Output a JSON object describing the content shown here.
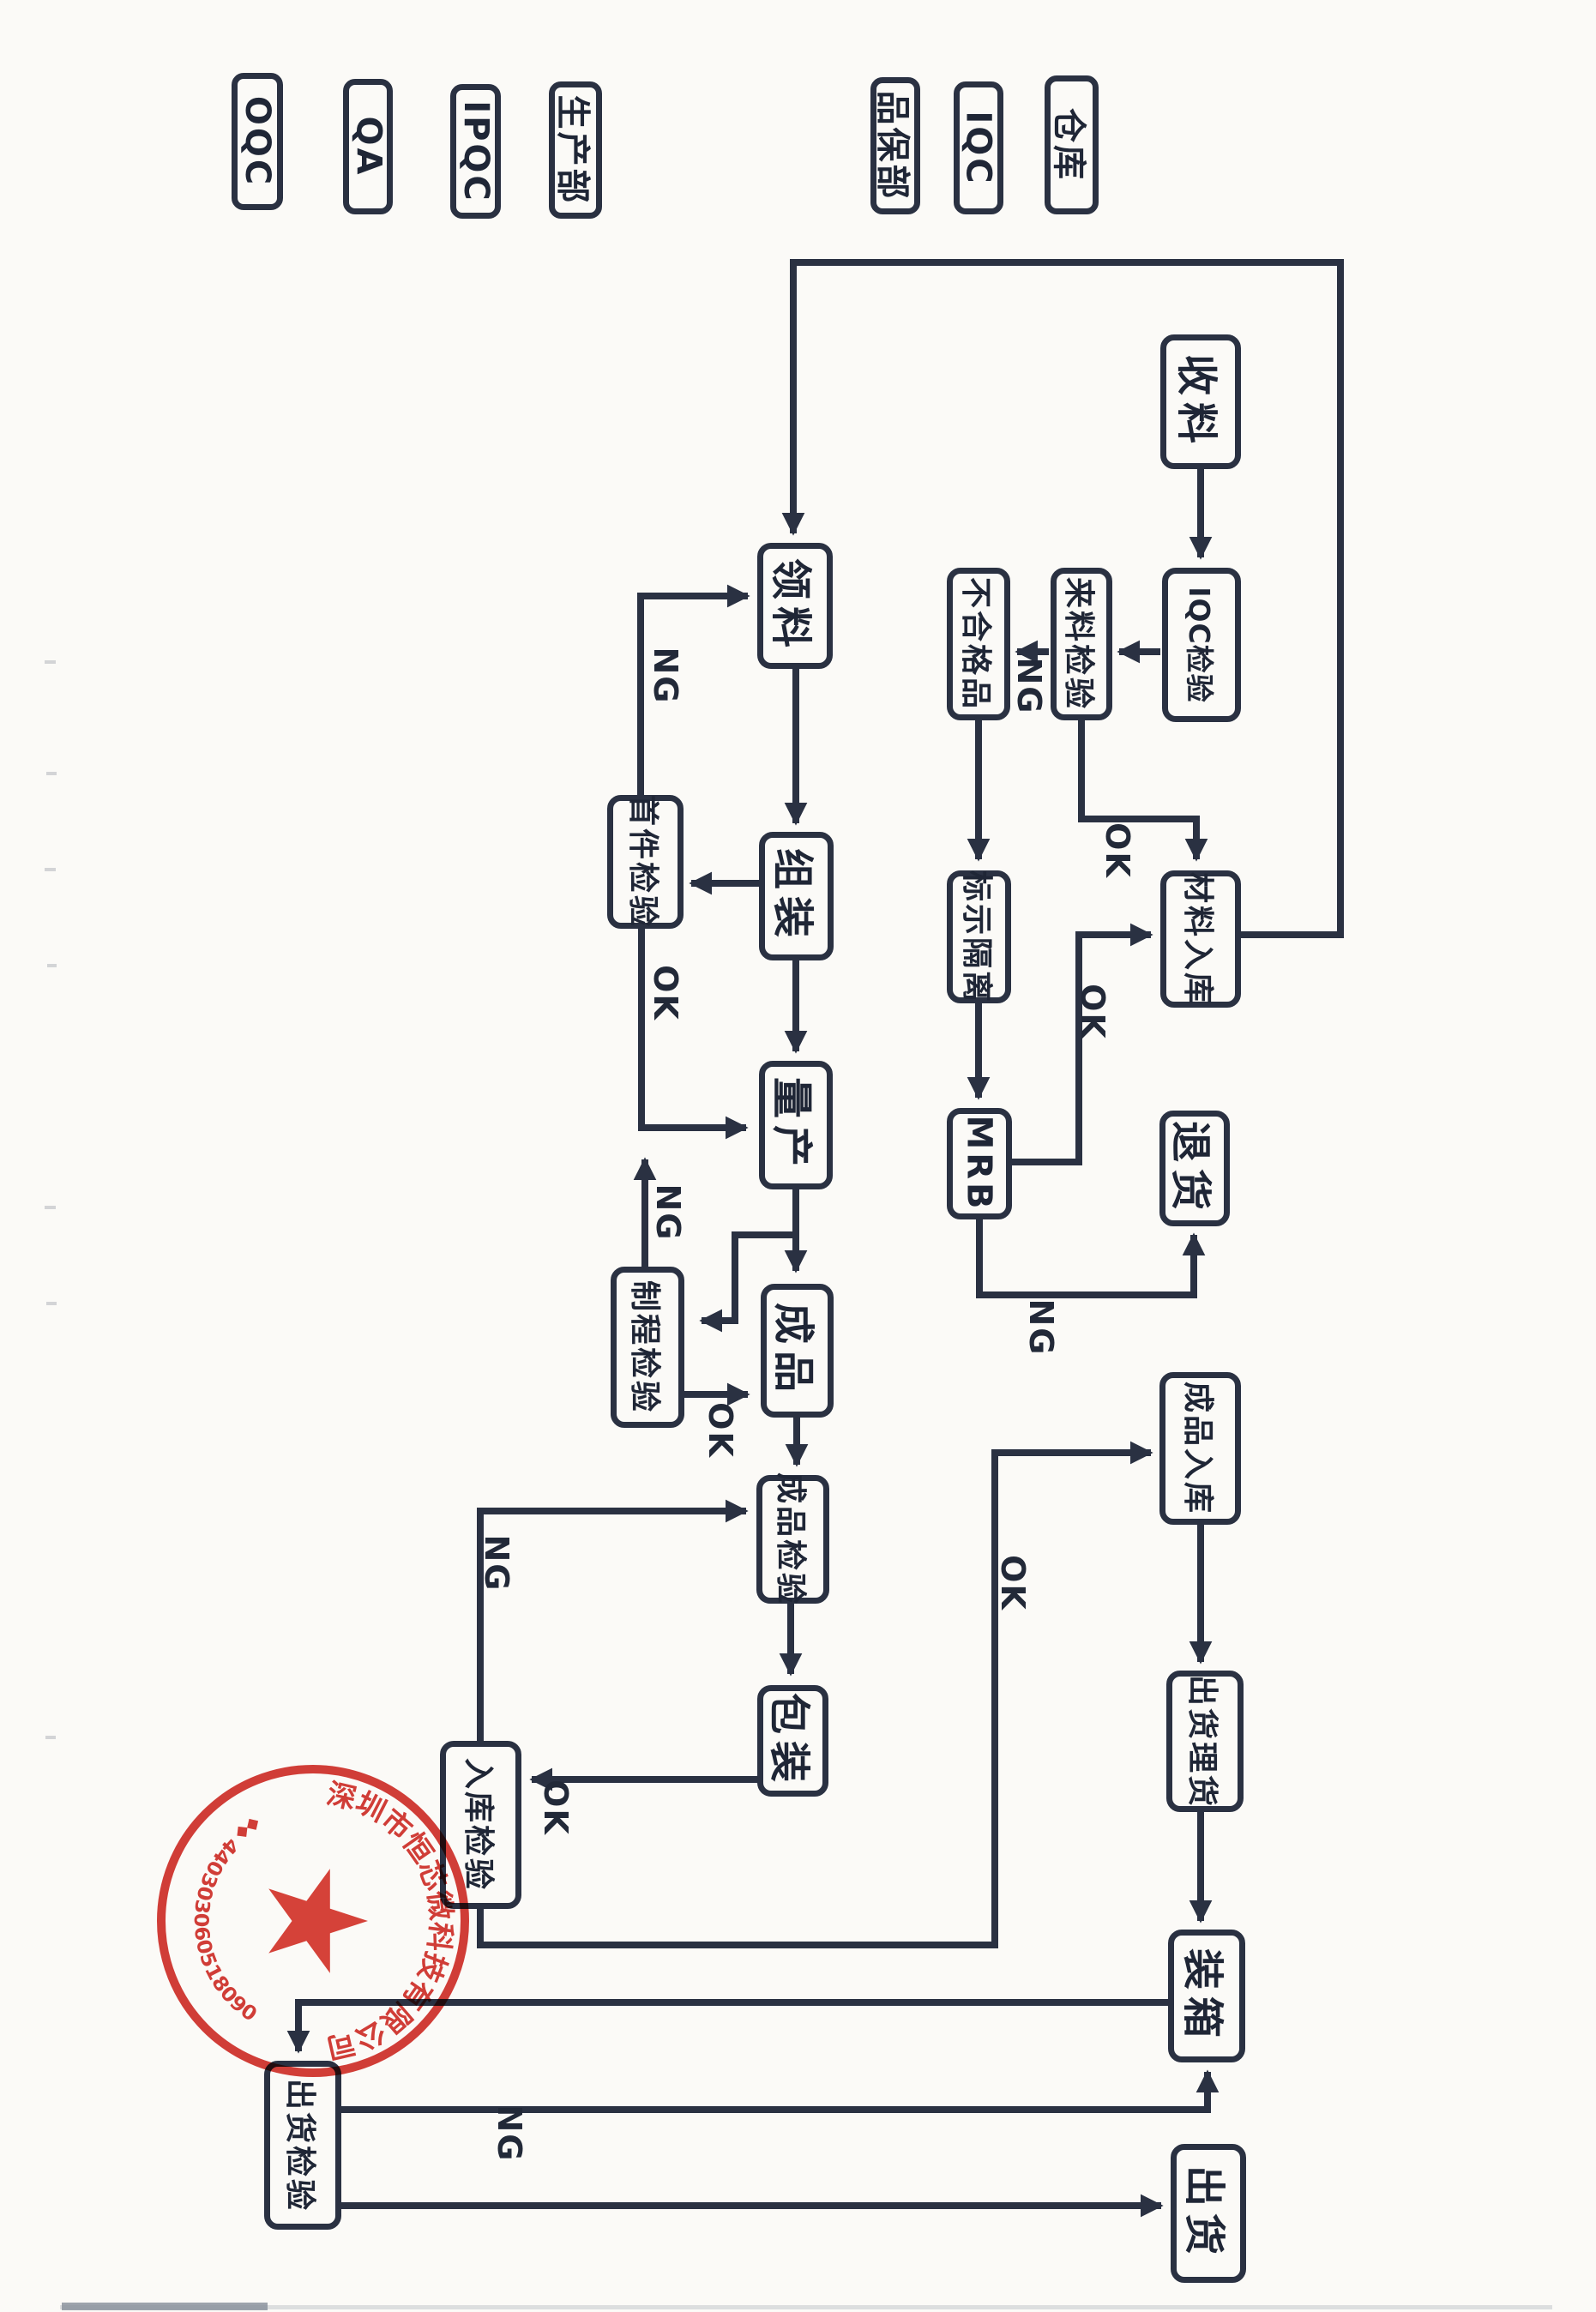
{
  "colors": {
    "ink": "#2a3142",
    "paper": "#fbfaf7",
    "stamp_red": "#cf241e"
  },
  "lanes": [
    "OQC",
    "QA",
    "IPQC",
    "生产部",
    "品保部",
    "IQC",
    "仓库"
  ],
  "nodes": {
    "receive_material": {
      "label": "收料"
    },
    "iqc_inspection": {
      "label": "IQC检验"
    },
    "incoming_inspection": {
      "label": "来料检验"
    },
    "nonconforming": {
      "label": "不合格品"
    },
    "mark_quarantine": {
      "label": "标示隔离"
    },
    "mrb": {
      "label": "MRB"
    },
    "material_storage": {
      "label": "材料入库"
    },
    "return_goods": {
      "label": "退货"
    },
    "pick_material": {
      "label": "领料"
    },
    "assembly": {
      "label": "组装"
    },
    "first_article": {
      "label": "首件检验"
    },
    "mass_production": {
      "label": "量产"
    },
    "process_inspection": {
      "label": "制程检验"
    },
    "finished_product": {
      "label": "成品"
    },
    "finished_inspection": {
      "label": "成品检验"
    },
    "packing": {
      "label": "包装"
    },
    "storage_inspection": {
      "label": "入库检验"
    },
    "finished_storage": {
      "label": "成品入库"
    },
    "shipping_prep": {
      "label": "出货理货"
    },
    "boxing": {
      "label": "装箱"
    },
    "shipping_inspection": {
      "label": "出货检验"
    },
    "shipping": {
      "label": "出货"
    }
  },
  "edge_labels": {
    "incoming_ng": "NG",
    "incoming_ok": "OK",
    "mrb_ok": "OK",
    "mrb_ng": "NG",
    "first_article_ng": "NG",
    "first_article_ok": "OK",
    "process_ng": "NG",
    "process_ok": "OK",
    "storage_inspection_ng": "NG",
    "packing_ok": "OK",
    "storage_inspection_ok": "OK",
    "shipping_inspection_ng": "NG"
  },
  "stamp": {
    "company_name": "深圳市恒芯微科技有限公司",
    "serial_number": "440303060518090",
    "separator": "◆◆"
  }
}
